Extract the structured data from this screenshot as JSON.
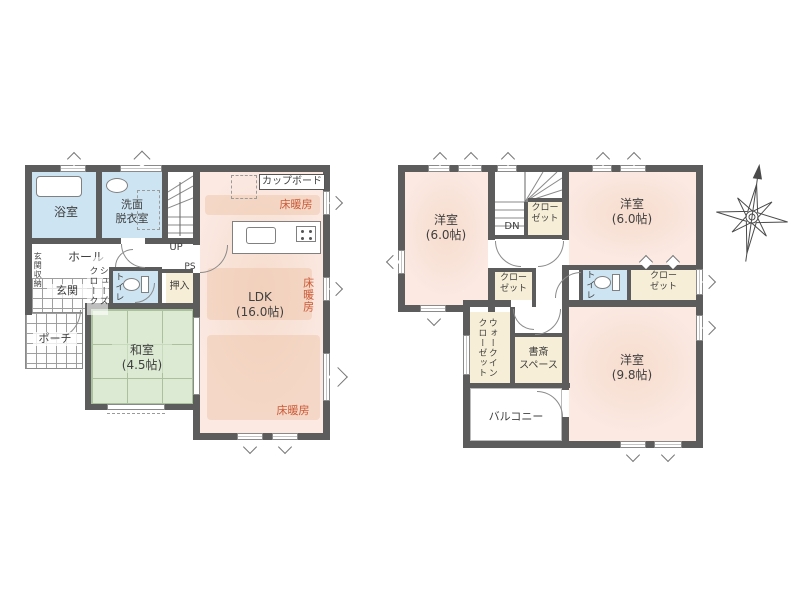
{
  "floor1": {
    "bathroom_label": "浴室",
    "washroom_label": "洗面\n脱衣室",
    "entrance_storage_label": "玄関収納",
    "hall_label": "ホール",
    "entrance_label": "玄関",
    "shoe_cloak_label": "シューズ\nクローク",
    "toilet_label": "トイレ",
    "oshiire_label": "押入",
    "ps_label": "PS",
    "up_label": "UP",
    "porch_label": "ポーチ",
    "washitsu_label": "和室\n(4.5帖)",
    "ldk_label": "LDK\n(16.0帖)",
    "cupboard_label": "カップボード",
    "floor_heating_label": "床暖房"
  },
  "floor2": {
    "bedroom1_label": "洋室\n(6.0帖)",
    "bedroom2_label": "洋室\n(6.0帖)",
    "bedroom3_label": "洋室\n(9.8帖)",
    "dn_label": "DN",
    "closet_label": "クロー\nゼット",
    "toilet_label": "トイレ",
    "walkin_closet_label": "ウォークイン\nクローゼット",
    "study_label": "書斎\nスペース",
    "balcony_label": "バルコニー"
  },
  "colors": {
    "wall": "#5c5c5c",
    "western_room_fill": "#fbe9e2",
    "floor_heating_fill": "#f0cdb7",
    "wet_area_fill": "#cde4f2",
    "tatami_fill": "#dcead3",
    "storage_fill": "#f6eed6",
    "heating_text": "#cc5a38"
  }
}
